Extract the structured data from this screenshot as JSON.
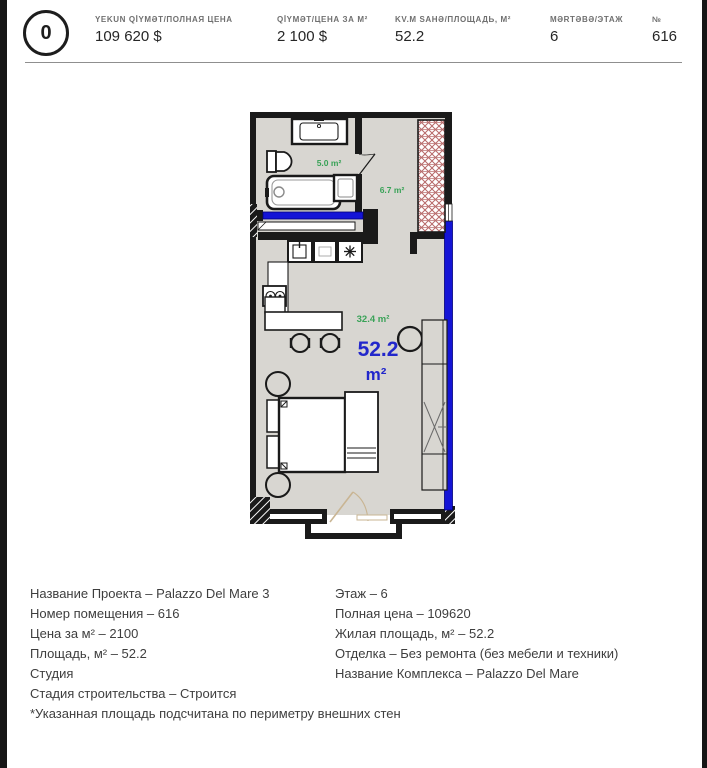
{
  "header": {
    "badge": "0",
    "stats": [
      {
        "label": "YEKUN QİYMƏT/ПОЛНАЯ ЦЕНА",
        "value": "109 620 $"
      },
      {
        "label": "QİYMƏT/ЦЕНА ЗА М²",
        "value": "2 100 $"
      },
      {
        "label": "KV.M SAHƏ/ПЛОЩАДЬ, М²",
        "value": "52.2"
      },
      {
        "label": "MƏRTƏBƏ/ЭТАЖ",
        "value": "6"
      },
      {
        "label": "№",
        "value": "616"
      }
    ]
  },
  "floorplan": {
    "rooms": {
      "bathroom_area": "5.0 m²",
      "hallway_area": "6.7 m²",
      "living_area": "32.4 m²"
    },
    "total_area_value": "52.2",
    "total_area_unit": "m²",
    "colors": {
      "wall": "#1a1a1a",
      "highlight_blue": "#1414d6",
      "area_green": "#39a257",
      "total_blue": "#2227cb",
      "floor": "#d8d6d1",
      "wardrobe_hatch": "#b76a6a",
      "door": "#c9b593"
    }
  },
  "details": {
    "left": [
      "Название Проекта – Palazzo Del Mare 3",
      "Номер помещения – 616",
      "Цена за м² – 2100",
      "Площадь, м² – 52.2",
      "Студия",
      "Стадия строительства – Строится",
      "*Указанная площадь подсчитана по периметру внешних стен"
    ],
    "right": [
      "Этаж – 6",
      "Полная цена – 109620",
      "Жилая площадь, м² – 52.2",
      "Отделка – Без ремонта (без мебели и техники)",
      "Название Комплекса – Palazzo Del Mare"
    ]
  }
}
